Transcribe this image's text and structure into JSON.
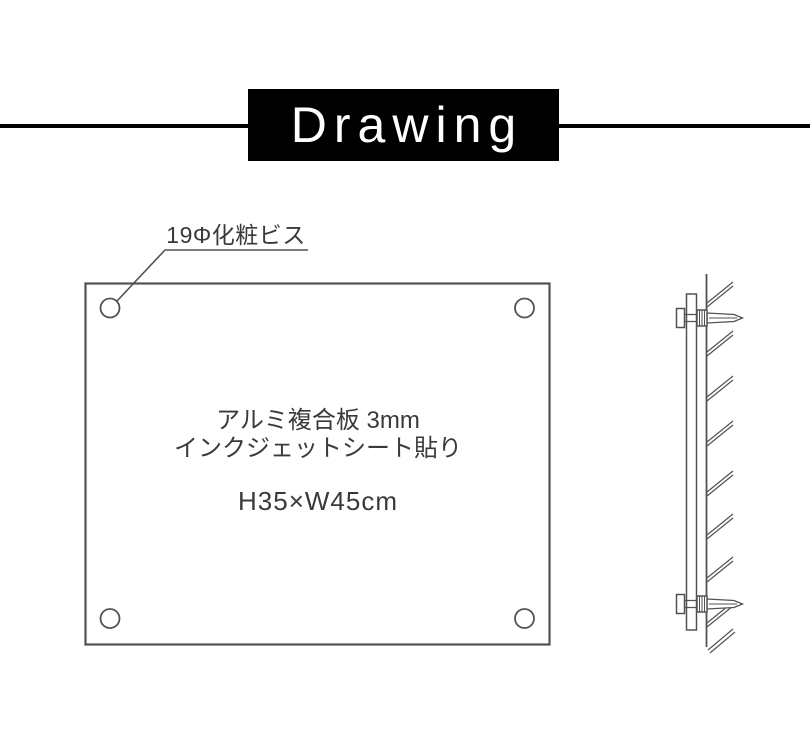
{
  "banner": {
    "title": "Drawing"
  },
  "front_view": {
    "callout": {
      "label": "19Φ化粧ビス"
    },
    "panel": {
      "material_line1": "アルミ複合板 3mm",
      "material_line2": "インクジェットシート貼り",
      "size": "H35×W45cm"
    }
  },
  "colors": {
    "background": "#ffffff",
    "banner_bg": "#000000",
    "banner_text": "#ffffff",
    "line": "#54524d",
    "text": "#3b3a37"
  }
}
